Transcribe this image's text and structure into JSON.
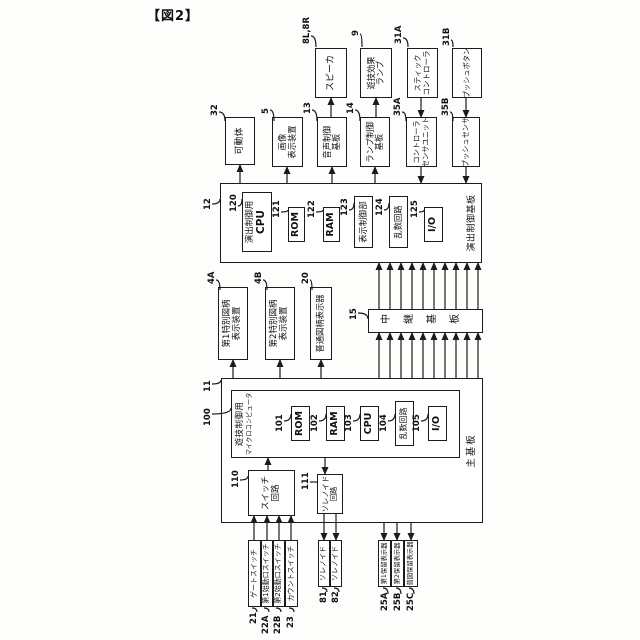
{
  "caption": "【図2】",
  "nodes": {
    "gate": {
      "ref": "21",
      "l1": "ゲートスイッチ"
    },
    "start1": {
      "ref": "22A",
      "l1": "第1始動口スイッチ"
    },
    "start2": {
      "ref": "22B",
      "l1": "第2始動口スイッチ"
    },
    "count": {
      "ref": "23",
      "l1": "カウントスイッチ"
    },
    "sol81": {
      "ref": "81",
      "l1": "ソレノイド"
    },
    "sol82": {
      "ref": "82",
      "l1": "ソレノイド"
    },
    "hold1": {
      "ref": "25A",
      "l1": "第1保留表示器"
    },
    "hold2": {
      "ref": "25B",
      "l1": "第2保留表示器"
    },
    "holdFu": {
      "ref": "25C",
      "l1": "普図保留表示器"
    },
    "mainBoard": {
      "ref": "11",
      "label": "主基板"
    },
    "micom": {
      "ref": "100",
      "l1": "遊技制御用",
      "l2": "マイクロコンピュータ"
    },
    "rom101": {
      "ref": "101",
      "l1": "ROM"
    },
    "ram102": {
      "ref": "102",
      "l1": "RAM"
    },
    "cpu103": {
      "ref": "103",
      "l1": "CPU"
    },
    "rnd104": {
      "ref": "104",
      "l1": "乱数回路"
    },
    "io105": {
      "ref": "105",
      "l1": "I/O"
    },
    "swCircuit": {
      "ref": "110",
      "l1": "スイッチ",
      "l2": "回路"
    },
    "solCircuit": {
      "ref": "111",
      "l1": "ソレノイド",
      "l2": "回路"
    },
    "relay": {
      "ref": "15",
      "l1": "中継基板"
    },
    "disp4A": {
      "ref": "4A",
      "l1": "第1特別図柄",
      "l2": "表示装置"
    },
    "disp4B": {
      "ref": "4B",
      "l1": "第2特別図柄",
      "l2": "表示装置"
    },
    "disp20": {
      "ref": "20",
      "l1": "普通図柄表示器"
    },
    "effectBoard": {
      "ref": "12",
      "label": "演出制御基板"
    },
    "cpu120": {
      "ref": "120",
      "l1": "演出制御用",
      "l2": "CPU"
    },
    "rom121": {
      "ref": "121",
      "l1": "ROM"
    },
    "ram122": {
      "ref": "122",
      "l1": "RAM"
    },
    "dispCtrl": {
      "ref": "123",
      "l1": "表示制御部"
    },
    "rnd124": {
      "ref": "124",
      "l1": "乱数回路"
    },
    "io125": {
      "ref": "125",
      "l1": "I/O"
    },
    "movable": {
      "ref": "32",
      "l1": "可動体"
    },
    "imageDisp": {
      "ref": "5",
      "l1": "画像",
      "l2": "表示装置"
    },
    "soundBoard": {
      "ref": "13",
      "l1": "音声制御",
      "l2": "基板"
    },
    "lampBoard": {
      "ref": "14",
      "l1": "ランプ制御",
      "l2": "基板"
    },
    "ctrlSensor": {
      "ref": "35A",
      "l1": "コントローラ",
      "l2": "センサユニット"
    },
    "pushSensor": {
      "ref": "35B",
      "l1": "プッシュセンサ"
    },
    "speaker": {
      "ref": "8L,8R",
      "l1": "スピーカ"
    },
    "effectLamp": {
      "ref": "9",
      "l1": "遊技効果",
      "l2": "ランプ"
    },
    "stick": {
      "ref": "31A",
      "l1": "スティック",
      "l2": "コントローラ"
    },
    "pushBtn": {
      "ref": "31B",
      "l1": "プッシュボタン"
    }
  }
}
